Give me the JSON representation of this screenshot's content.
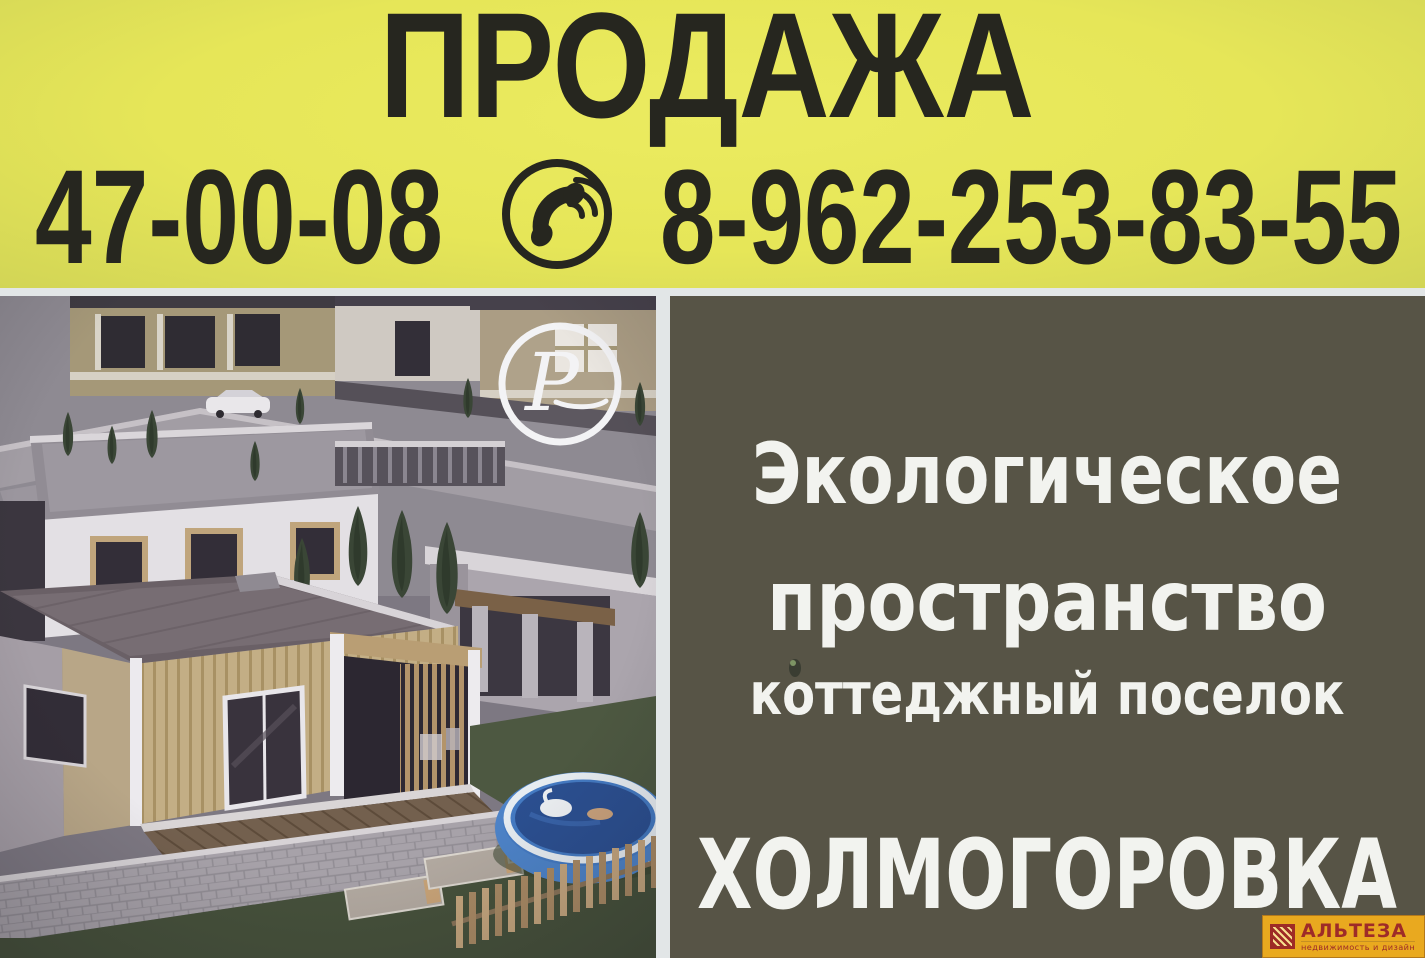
{
  "header": {
    "title": "ПРОДАЖА",
    "phone_local": "47-00-08",
    "phone_mobile": "8-962-253-83-55",
    "phone_icon": "phone-handset-in-circle",
    "bg_color": "#e6e658",
    "text_color": "#26261f"
  },
  "photo": {
    "monogram": "P",
    "monogram_icon": "p-script-monogram-in-circle"
  },
  "panel": {
    "bg_color": "#575446",
    "text_color": "#f2f3ef",
    "line1": "Экологическое",
    "line2": "пространство",
    "line3": "коттеджный поселок",
    "village_name": "ХОЛМОГОРОВКА"
  },
  "altesa": {
    "title": "АЛЬТЕЗА",
    "subtitle": "недвижимость и дизайн",
    "icon": "striped-blinds-square",
    "bg_color": "#e9a91f",
    "text_color": "#9e2b28"
  }
}
